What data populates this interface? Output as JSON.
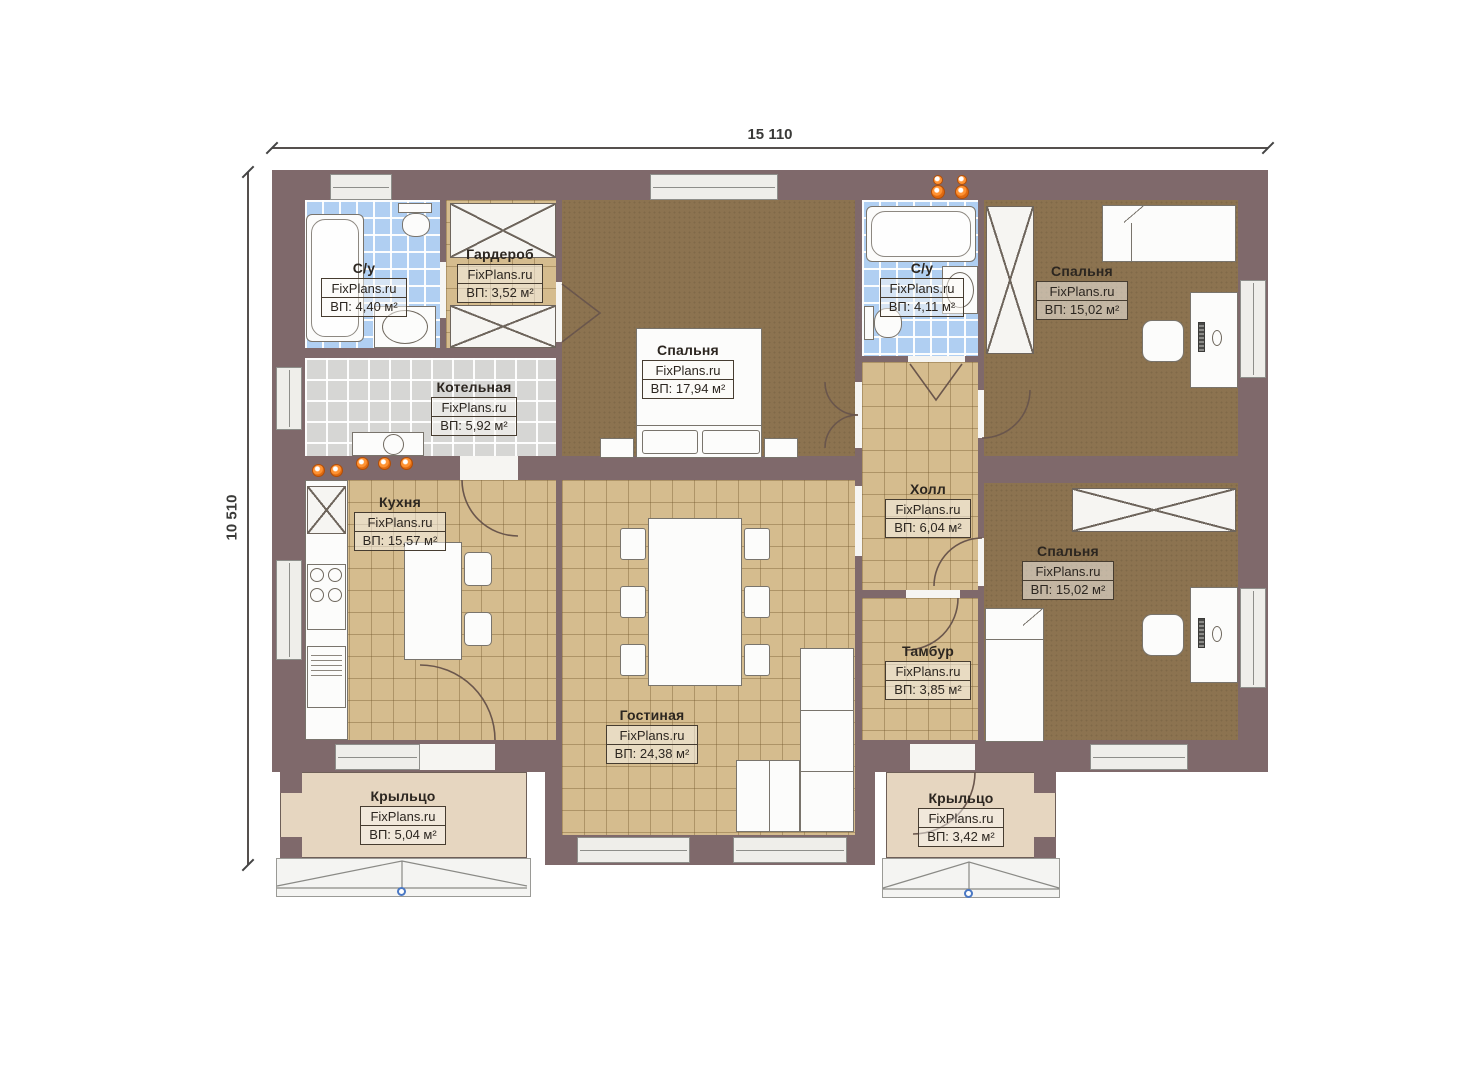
{
  "title": "План этажа одноэтажного дома",
  "watermark": "FixPlans.ru",
  "dimensions": {
    "top": "15 110",
    "left": "10 510"
  },
  "rooms": [
    {
      "id": "su1",
      "name": "С/у",
      "area": "ВП: 4,40 м²"
    },
    {
      "id": "wardrobe",
      "name": "Гардероб",
      "area": "ВП: 3,52 м²"
    },
    {
      "id": "boiler",
      "name": "Котельная",
      "area": "ВП: 5,92 м²"
    },
    {
      "id": "bedroom1",
      "name": "Спальня",
      "area": "ВП: 17,94 м²"
    },
    {
      "id": "su2",
      "name": "С/у",
      "area": "ВП: 4,11 м²"
    },
    {
      "id": "bedroom2",
      "name": "Спальня",
      "area": "ВП: 15,02 м²"
    },
    {
      "id": "kitchen",
      "name": "Кухня",
      "area": "ВП: 15,57 м²"
    },
    {
      "id": "hall",
      "name": "Холл",
      "area": "ВП: 6,04 м²"
    },
    {
      "id": "bedroom3",
      "name": "Спальня",
      "area": "ВП: 15,02 м²"
    },
    {
      "id": "tambur",
      "name": "Тамбур",
      "area": "ВП: 3,85 м²"
    },
    {
      "id": "living",
      "name": "Гостиная",
      "area": "ВП: 24,38 м²"
    },
    {
      "id": "porch_left",
      "name": "Крыльцо",
      "area": "ВП: 5,04 м²"
    },
    {
      "id": "porch_right",
      "name": "Крыльцо",
      "area": "ВП: 3,42 м²"
    }
  ],
  "colors": {
    "wall": "#7f696b",
    "carpet": "#8c7350",
    "tile": "#d5bc8e",
    "bath_tile": "#b0cff2",
    "boiler_tile": "#d6d6d4",
    "porch": "#e6d6c0",
    "equipment_orange": "#f07a1e",
    "marker_blue": "#4a78c4"
  }
}
